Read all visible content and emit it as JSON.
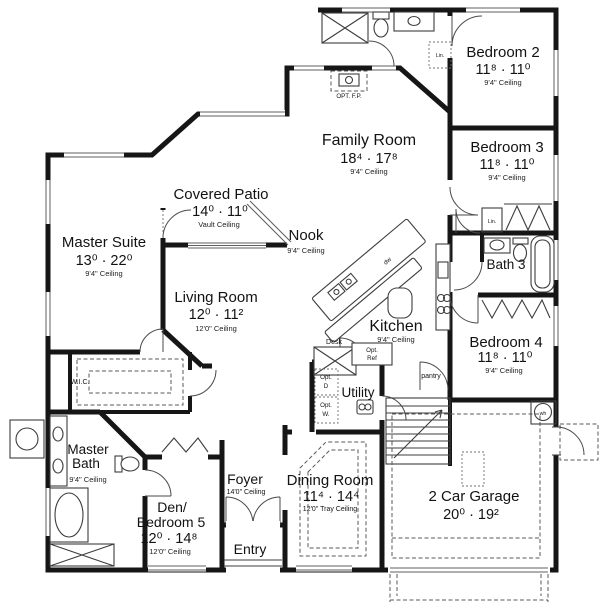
{
  "rooms": {
    "master_suite": {
      "name": "Master Suite",
      "dims": "13⁰ · 22⁰",
      "ceiling": "9'4\" Ceiling"
    },
    "covered_patio": {
      "name": "Covered Patio",
      "dims": "14⁰ · 11⁰",
      "ceiling": "Vault Ceiling"
    },
    "family_room": {
      "name": "Family Room",
      "dims": "18⁴ · 17⁸",
      "ceiling": "9'4\" Ceiling"
    },
    "living_room": {
      "name": "Living Room",
      "dims": "12⁰ · 11²",
      "ceiling": "12'0\" Ceiling"
    },
    "nook": {
      "name": "Nook",
      "ceiling": "9'4\" Ceiling"
    },
    "kitchen": {
      "name": "Kitchen",
      "ceiling": "9'4\" Ceiling"
    },
    "bedroom_2": {
      "name": "Bedroom 2",
      "dims": "11⁸ · 11⁰",
      "ceiling": "9'4\" Ceiling"
    },
    "bedroom_3": {
      "name": "Bedroom 3",
      "dims": "11⁸ · 11⁰",
      "ceiling": "9'4\" Ceiling"
    },
    "bath_3": {
      "name": "Bath 3"
    },
    "bedroom_4": {
      "name": "Bedroom 4",
      "dims": "11⁸ · 11⁰",
      "ceiling": "9'4\" Ceiling"
    },
    "wic": {
      "name": "W.I.C."
    },
    "master_bath": {
      "line1": "Master",
      "line2": "Bath",
      "ceiling": "9'4\" Ceiling"
    },
    "den_bedroom_5": {
      "line1": "Den/",
      "line2": "Bedroom 5",
      "dims": "12⁰ · 14⁸",
      "ceiling": "12'0\" Ceiling"
    },
    "foyer": {
      "name": "Foyer",
      "ceiling": "14'0\" Ceiling"
    },
    "entry": {
      "name": "Entry"
    },
    "dining_room": {
      "name": "Dining Room",
      "dims": "11⁴ · 14⁴",
      "ceiling": "12'0\" Tray Ceiling"
    },
    "garage": {
      "name": "2 Car Garage",
      "dims": "20⁰ · 19²"
    },
    "utility": {
      "name": "Utility"
    }
  },
  "annotations": {
    "opt_fireplace": "OPT. F.P.",
    "desk": "Desk",
    "opt_ref_line1": "Opt.",
    "opt_ref_line2": "Ref",
    "pantry": "pantry",
    "opt_dryer_line1": "Opt.",
    "opt_dryer_line2": "D",
    "opt_washer_line1": "Opt.",
    "opt_washer_line2": "W.",
    "dishwasher": "dw",
    "water_heater": "wh",
    "linen_hall": "Lin.",
    "linen_bed3": "Lin."
  },
  "colors": {
    "wall": "#161616",
    "background": "#ffffff"
  }
}
